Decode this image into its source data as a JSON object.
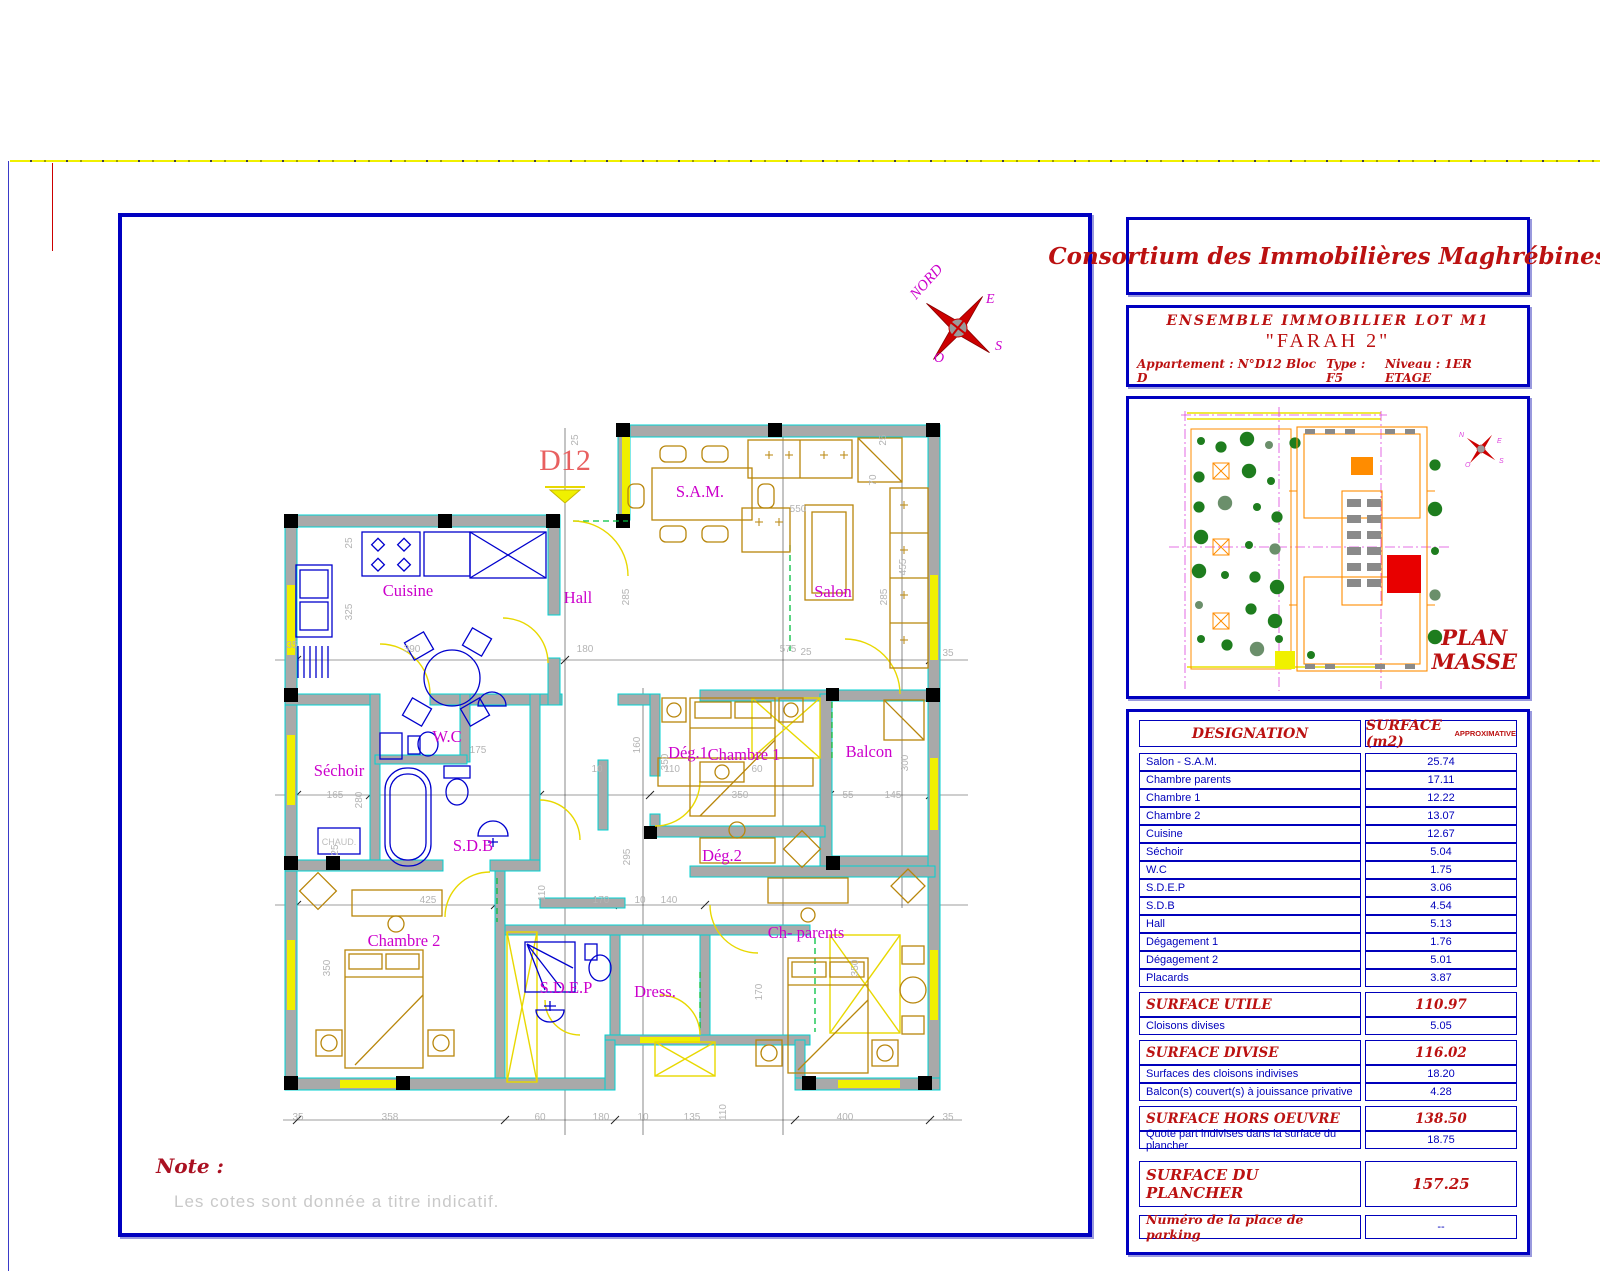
{
  "company": {
    "name": "Consortium des Immobilières Maghrébines"
  },
  "project": {
    "line1": "ENSEMBLE   IMMOBILIER  LOT  M1",
    "name": "\"FARAH 2\"",
    "apartment": "Appartement :  N°D12 Bloc D",
    "type": "Type : F5",
    "level": "Niveau : 1ER ETAGE"
  },
  "plan_masse": {
    "title_line1": "PLAN",
    "title_line2": "MASSE"
  },
  "note": {
    "label": "Note :",
    "text": "Les cotes sont donnée a titre indicatif."
  },
  "floor_plan": {
    "apartment_label": "D12",
    "compass": {
      "north": "NORD",
      "east": "E",
      "west": "O",
      "south": "S"
    },
    "fixture_label": "CHAUD.",
    "rooms": [
      {
        "n": "Cuisine",
        "x": 408,
        "y": 596
      },
      {
        "n": "Hall",
        "x": 578,
        "y": 603
      },
      {
        "n": "S.A.M.",
        "x": 700,
        "y": 497
      },
      {
        "n": "Salon",
        "x": 833,
        "y": 597
      },
      {
        "n": "Séchoir",
        "x": 339,
        "y": 776
      },
      {
        "n": "W.C",
        "x": 447,
        "y": 742
      },
      {
        "n": "S.D.B",
        "x": 473,
        "y": 851
      },
      {
        "n": "Dég.1",
        "x": 688,
        "y": 758
      },
      {
        "n": "Dég.2",
        "x": 722,
        "y": 861
      },
      {
        "n": "Chambre 1",
        "x": 744,
        "y": 760
      },
      {
        "n": "Balcon",
        "x": 869,
        "y": 757
      },
      {
        "n": "Chambre 2",
        "x": 404,
        "y": 946
      },
      {
        "n": "S.D.E.P",
        "x": 566,
        "y": 993
      },
      {
        "n": "Dress.",
        "x": 655,
        "y": 997
      },
      {
        "n": "Ch- parents",
        "x": 806,
        "y": 938
      }
    ],
    "dimensions": [
      {
        "t": "25",
        "x": 352,
        "y": 543,
        "r": -90
      },
      {
        "t": "325",
        "x": 352,
        "y": 612,
        "r": -90
      },
      {
        "t": "390",
        "x": 412,
        "y": 652,
        "r": 0
      },
      {
        "t": "180",
        "x": 585,
        "y": 652,
        "r": 0
      },
      {
        "t": "285",
        "x": 629,
        "y": 597,
        "r": -90
      },
      {
        "t": "25",
        "x": 806,
        "y": 655,
        "r": 0
      },
      {
        "t": "575",
        "x": 788,
        "y": 652,
        "r": 0
      },
      {
        "t": "550",
        "x": 798,
        "y": 512,
        "r": 0
      },
      {
        "t": "70",
        "x": 876,
        "y": 480,
        "r": -90
      },
      {
        "t": "285",
        "x": 887,
        "y": 597,
        "r": -90
      },
      {
        "t": "455",
        "x": 906,
        "y": 567,
        "r": -90
      },
      {
        "t": "35",
        "x": 948,
        "y": 656,
        "r": 0
      },
      {
        "t": "35",
        "x": 292,
        "y": 648,
        "r": 0
      },
      {
        "t": "165",
        "x": 335,
        "y": 798,
        "r": 0
      },
      {
        "t": "280",
        "x": 362,
        "y": 800,
        "r": -90
      },
      {
        "t": "175",
        "x": 478,
        "y": 753,
        "r": 0
      },
      {
        "t": "10",
        "x": 597,
        "y": 772,
        "r": 0
      },
      {
        "t": "110",
        "x": 672,
        "y": 772,
        "r": 0
      },
      {
        "t": "60",
        "x": 757,
        "y": 772,
        "r": 0
      },
      {
        "t": "160",
        "x": 640,
        "y": 745,
        "r": -90
      },
      {
        "t": "350",
        "x": 740,
        "y": 798,
        "r": 0
      },
      {
        "t": "350",
        "x": 668,
        "y": 762,
        "r": -90
      },
      {
        "t": "55",
        "x": 848,
        "y": 798,
        "r": 0
      },
      {
        "t": "145",
        "x": 893,
        "y": 798,
        "r": 0
      },
      {
        "t": "300",
        "x": 908,
        "y": 763,
        "r": -90
      },
      {
        "t": "295",
        "x": 630,
        "y": 857,
        "r": -90
      },
      {
        "t": "110",
        "x": 545,
        "y": 893,
        "r": -90
      },
      {
        "t": "425",
        "x": 428,
        "y": 903,
        "r": 0
      },
      {
        "t": "170",
        "x": 601,
        "y": 903,
        "r": 0
      },
      {
        "t": "10",
        "x": 640,
        "y": 903,
        "r": 0
      },
      {
        "t": "140",
        "x": 669,
        "y": 903,
        "r": 0
      },
      {
        "t": "25",
        "x": 338,
        "y": 850,
        "r": -90
      },
      {
        "t": "350",
        "x": 330,
        "y": 968,
        "r": -90
      },
      {
        "t": "350",
        "x": 858,
        "y": 968,
        "r": -90
      },
      {
        "t": "170",
        "x": 762,
        "y": 992,
        "r": -90
      },
      {
        "t": "35",
        "x": 298,
        "y": 1120,
        "r": 0
      },
      {
        "t": "358",
        "x": 390,
        "y": 1120,
        "r": 0
      },
      {
        "t": "60",
        "x": 540,
        "y": 1120,
        "r": 0
      },
      {
        "t": "180",
        "x": 601,
        "y": 1120,
        "r": 0
      },
      {
        "t": "10",
        "x": 643,
        "y": 1120,
        "r": 0
      },
      {
        "t": "135",
        "x": 692,
        "y": 1120,
        "r": 0
      },
      {
        "t": "110",
        "x": 726,
        "y": 1112,
        "r": -90
      },
      {
        "t": "400",
        "x": 845,
        "y": 1120,
        "r": 0
      },
      {
        "t": "35",
        "x": 948,
        "y": 1120,
        "r": 0
      },
      {
        "t": "25",
        "x": 578,
        "y": 440,
        "r": -90
      },
      {
        "t": "25",
        "x": 886,
        "y": 440,
        "r": -90
      }
    ]
  },
  "surface_table": {
    "header": {
      "designation": "DESIGNATION",
      "surface": "SURFACE  (m2)",
      "approx": "APPROXIMATIVE"
    },
    "rows": [
      {
        "label": "Salon - S.A.M.",
        "value": "25.74",
        "type": "normal"
      },
      {
        "label": "Chambre parents",
        "value": "17.11",
        "type": "normal"
      },
      {
        "label": "Chambre 1",
        "value": "12.22",
        "type": "normal"
      },
      {
        "label": "Chambre 2",
        "value": "13.07",
        "type": "normal"
      },
      {
        "label": "Cuisine",
        "value": "12.67",
        "type": "normal"
      },
      {
        "label": "Séchoir",
        "value": "5.04",
        "type": "normal"
      },
      {
        "label": "W.C",
        "value": "1.75",
        "type": "normal"
      },
      {
        "label": "S.D.E.P",
        "value": "3.06",
        "type": "normal"
      },
      {
        "label": "S.D.B",
        "value": "4.54",
        "type": "normal"
      },
      {
        "label": "Hall",
        "value": "5.13",
        "type": "normal"
      },
      {
        "label": "Dégagement 1",
        "value": "1.76",
        "type": "normal"
      },
      {
        "label": "Dégagement 2",
        "value": "5.01",
        "type": "normal"
      },
      {
        "label": "Placards",
        "value": "3.87",
        "type": "normal"
      },
      {
        "label": "SURFACE  UTILE",
        "value": "110.97",
        "type": "section"
      },
      {
        "label": "Cloisons divises",
        "value": "5.05",
        "type": "normal"
      },
      {
        "label": "SURFACE  DIVISE",
        "value": "116.02",
        "type": "section"
      },
      {
        "label": "Surfaces des cloisons indivises",
        "value": "18.20",
        "type": "normal"
      },
      {
        "label": "Balcon(s) couvert(s) à jouissance privative",
        "value": "4.28",
        "type": "normal"
      },
      {
        "label": "SURFACE  HORS  OEUVRE",
        "value": "138.50",
        "type": "section"
      },
      {
        "label": "Quote part indivises dans la surface du plancher",
        "value": "18.75",
        "type": "normal"
      }
    ],
    "plancher": {
      "label": "SURFACE  DU  PLANCHER",
      "value": "157.25"
    },
    "parking": {
      "label": "Numéro de la place de parking",
      "value": "--"
    }
  },
  "colors": {
    "frame_blue": "#0000c0",
    "table_blue": "#0000bb",
    "title_red": "#bb1111",
    "wall_gray": "#a9a9a9",
    "wall_edge_cyan": "#00d2d2",
    "accent_yellow": "#f0f000",
    "label_magenta": "#cc00cc",
    "dim_gray": "#b4b4b4",
    "fixture_blue": "#0000cd",
    "furniture_gold": "#b8860b",
    "open_green": "#00c040",
    "site_orange": "#ff8c00",
    "tree_green": "#1e7d1e",
    "highlight_red": "#e80000"
  }
}
